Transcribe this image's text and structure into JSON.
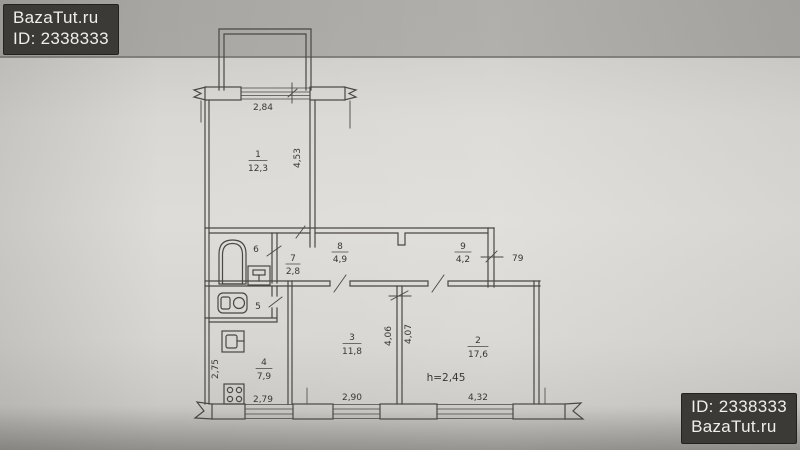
{
  "watermark": {
    "site": "BazaTut.ru",
    "id": "ID: 2338333"
  },
  "plan": {
    "rooms": {
      "r1": {
        "number": "1",
        "area": "12,3"
      },
      "r2": {
        "number": "2",
        "area": "17,6"
      },
      "r3": {
        "number": "3",
        "area": "11,8"
      },
      "r4": {
        "number": "4",
        "area": "7,9"
      },
      "r5": {
        "number": "5"
      },
      "r6": {
        "number": "6"
      },
      "r7": {
        "number": "7",
        "area": "2,8"
      },
      "r8": {
        "number": "8",
        "area": "4,9"
      },
      "r9": {
        "number": "9",
        "area": "4,2"
      }
    },
    "dims": {
      "balcony_window": "2,84",
      "room1_depth": "4,53",
      "kitchen_depth": "2,75",
      "kitchen_width": "2,79",
      "room3_width": "2,90",
      "room3_depth": "4,06",
      "room2_depth": "4,07",
      "room2_width": "4,32",
      "hall_side": "79",
      "ceiling_height": "h=2,45"
    }
  }
}
